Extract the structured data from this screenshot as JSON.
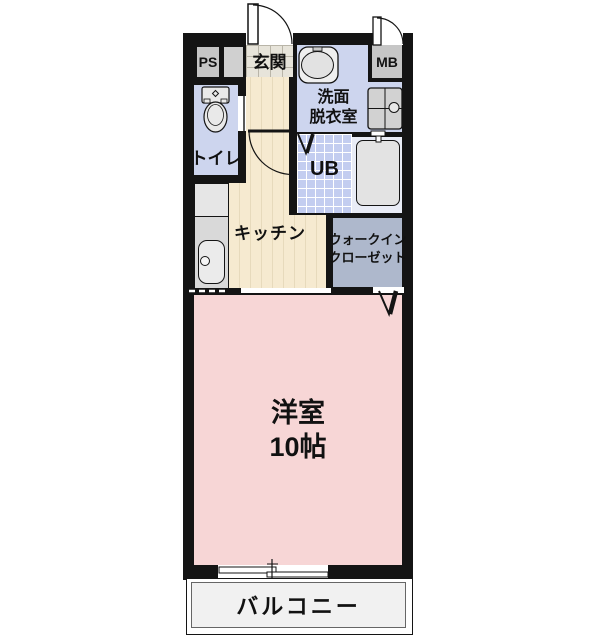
{
  "floorplan": {
    "type": "japanese-apartment-floor-plan",
    "labels": {
      "ps": "PS",
      "entrance": "玄関",
      "mb": "MB",
      "washroom_line1": "洗面",
      "washroom_line2": "脱衣室",
      "toilet": "トイレ",
      "unit_bath": "UB",
      "kitchen": "キッチン",
      "closet_line1": "ウォークイン",
      "closet_line2": "クローゼット",
      "main_room": "洋室",
      "main_room_size": "10帖",
      "balcony": "バルコニー"
    },
    "colors": {
      "wall": "#141414",
      "room_blue": "#cdd5ee",
      "ub_tile_blue": "#c3cdf0",
      "kitchen_beige": "#f6ead0",
      "main_room_pink": "#f7d6d6",
      "closet_blue_gray": "#aeb8cc",
      "utility_box_gray": "#c6c6c6",
      "balcony_gray": "#f1f1f1",
      "entrance_tile": "#e7e4da"
    },
    "icons": {
      "toilet-icon": "toilet tank and bowl, top view",
      "vanity-sink-icon": "washbasin oval in rounded square",
      "washing-machine-icon": "washer pan with cross and drain circle",
      "bathtub-icon": "rounded rectangle tub with tap",
      "kitchen-sink-icon": "sink with drain circle in counter",
      "door-swing-icon": "quarter-circle door swing arcs",
      "folding-door-icon": "V-shaped folding door marks",
      "sliding-window-icon": "offset double line window symbol"
    }
  }
}
